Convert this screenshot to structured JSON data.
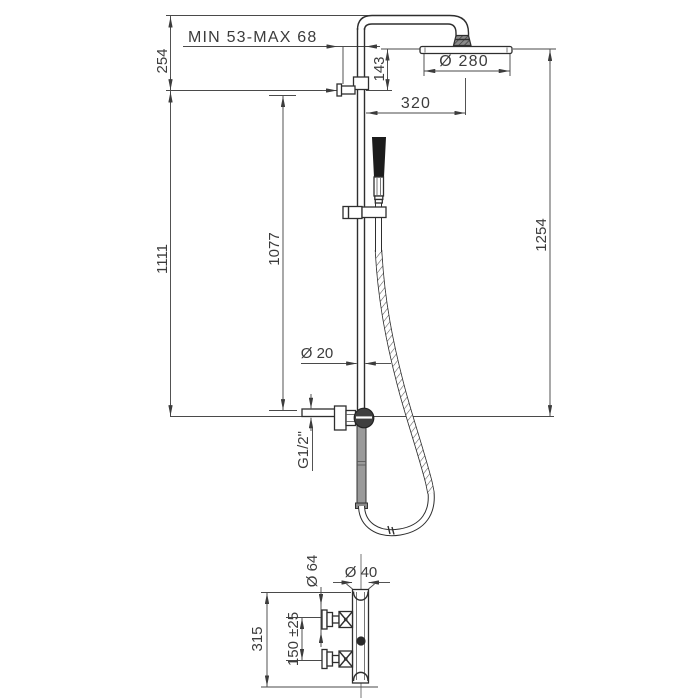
{
  "colors": {
    "background": "#ffffff",
    "product_line": "#2e2e2e",
    "dimension_line": "#4a4a4a",
    "text": "#3c3c3c",
    "handle_fill": "#1c1c1c",
    "gray_pipe_fill": "#9a9a9a"
  },
  "labels": {
    "adjust_range": "MIN 53-MAX 68",
    "top_offset": "254",
    "head_to_bracket": "143",
    "head_diameter": "Ø 280",
    "arm_reach": "320",
    "bracket_to_supply": "1111",
    "slide_height": "1077",
    "head_to_supply": "1254",
    "riser_diameter": "Ø 20",
    "connection_thread": "G1/2\"",
    "handle_diameter": "Ø 64",
    "body_diameter": "Ø 40",
    "mixer_height": "315",
    "inlet_spacing": "150 ±25"
  }
}
